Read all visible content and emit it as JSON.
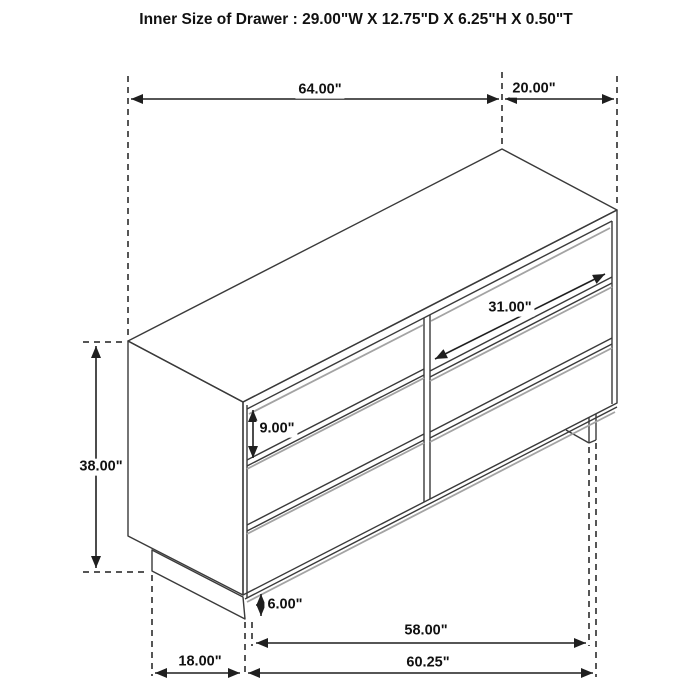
{
  "title": "Inner Size of Drawer : 29.00\"W X 12.75\"D X 6.25\"H X 0.50\"T",
  "figure": {
    "description": "isometric line drawing of a six-drawer dresser with two columns of three drawers on a recessed base"
  },
  "dimensions": {
    "top_width": "64.00\"",
    "top_depth": "20.00\"",
    "overall_height": "38.00\"",
    "drawer_front_width": "31.00\"",
    "drawer_front_height": "9.00\"",
    "base_height": "6.00\"",
    "base_span": "58.00\"",
    "base_depth": "18.00\"",
    "bottom_width": "60.25\""
  },
  "colors": {
    "outline": "#3a3a3a",
    "dimension_line": "#1f1f1f",
    "shadow_line": "#a3a3a3",
    "text": "#111111",
    "background": "#ffffff"
  }
}
